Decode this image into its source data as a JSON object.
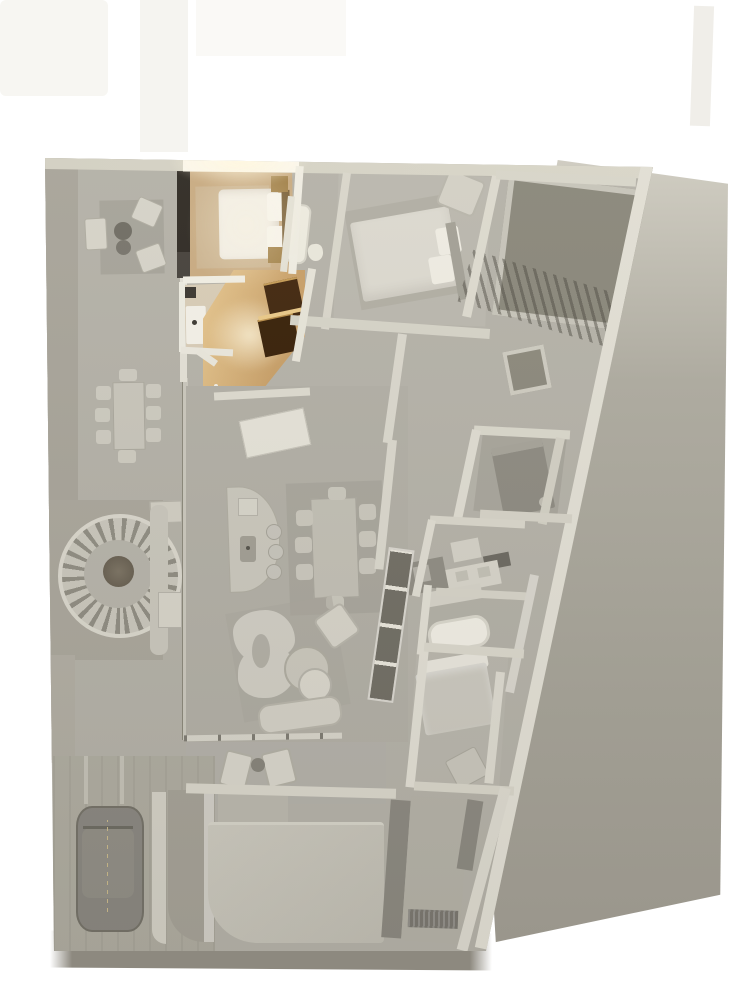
{
  "meta": {
    "kind": "3d-floor-plan-render",
    "view": "top-down",
    "background": "white",
    "canvas_w": 730,
    "canvas_h": 1000
  },
  "palette": {
    "bg": "#ffffff",
    "ground": "#a8a59b",
    "groundLight": "#d0cdc2",
    "base": "#b4b1a7",
    "wall": "#dedbd0",
    "wallBright": "#f8f4e8",
    "wallShadow": "#b3b0a5",
    "street": "#8d897f",
    "gravel": "#a7a398",
    "courtyard": "#898679",
    "woodFloor": "#c8aa80",
    "woodLit": "#dcb97f",
    "woodDark": "#40250c",
    "rugWarm": "#ccb490",
    "bedWhite": "#f2eee5",
    "headboardDark": "#2e2922",
    "nightstand": "#a28148",
    "tile": "#d7cbb5",
    "furnLight": "#cfccc2",
    "furnMid": "#b1aea4",
    "furnDark": "#8d8a80",
    "shelfDark": "#716e64",
    "car": "#8a8780",
    "slab": "#c5c2b7",
    "glow": "#fff6de"
  },
  "highlight": {
    "state": "selected",
    "rooms": [
      "bedroom-1",
      "bathroom-1",
      "hallway-wood"
    ],
    "style": "warm-lit-wood"
  },
  "rooms": [
    {
      "id": "terrace-west",
      "highlighted": false
    },
    {
      "id": "bedroom-1",
      "highlighted": true
    },
    {
      "id": "bathroom-1",
      "highlighted": true
    },
    {
      "id": "hallway-wood",
      "highlighted": true
    },
    {
      "id": "bedroom-2",
      "highlighted": false
    },
    {
      "id": "ensuite-bathroom-2",
      "highlighted": false
    },
    {
      "id": "courtyard-gravel",
      "highlighted": false
    },
    {
      "id": "corridor",
      "highlighted": false
    },
    {
      "id": "bedroom-3",
      "highlighted": false
    },
    {
      "id": "bathroom-3",
      "highlighted": false
    },
    {
      "id": "laundry",
      "highlighted": false
    },
    {
      "id": "ensuite-bathroom-4",
      "highlighted": false
    },
    {
      "id": "bedroom-4",
      "highlighted": false
    },
    {
      "id": "living-room",
      "highlighted": false
    },
    {
      "id": "kitchen",
      "highlighted": false
    },
    {
      "id": "dining-area",
      "highlighted": false
    },
    {
      "id": "south-terrace",
      "highlighted": false
    },
    {
      "id": "garage-driveway",
      "highlighted": false
    },
    {
      "id": "entry-path",
      "highlighted": false
    },
    {
      "id": "street",
      "highlighted": false
    }
  ],
  "furniture": [
    "outdoor-seating-set",
    "outdoor-dining-table-8-chairs",
    "semicircular-slatted-bench",
    "tree",
    "double-bed-1",
    "nightstands",
    "wardrobe",
    "washbasin-1",
    "wood-closets",
    "double-bed-2",
    "armchair",
    "bathtub-2",
    "toilet-2",
    "bunk-bed-3",
    "vanity-3",
    "shower-3",
    "washing-machine",
    "freestanding-bathtub-4",
    "vanity-4",
    "double-bed-4",
    "bench-4",
    "kitchen-island-with-sink",
    "bar-stools",
    "dining-table-8-chairs",
    "media-shelf",
    "curved-sofa",
    "round-coffee-tables",
    "lounge-armchair",
    "bench-sofa",
    "deck-chairs-pair",
    "side-table",
    "car",
    "door-mat"
  ]
}
